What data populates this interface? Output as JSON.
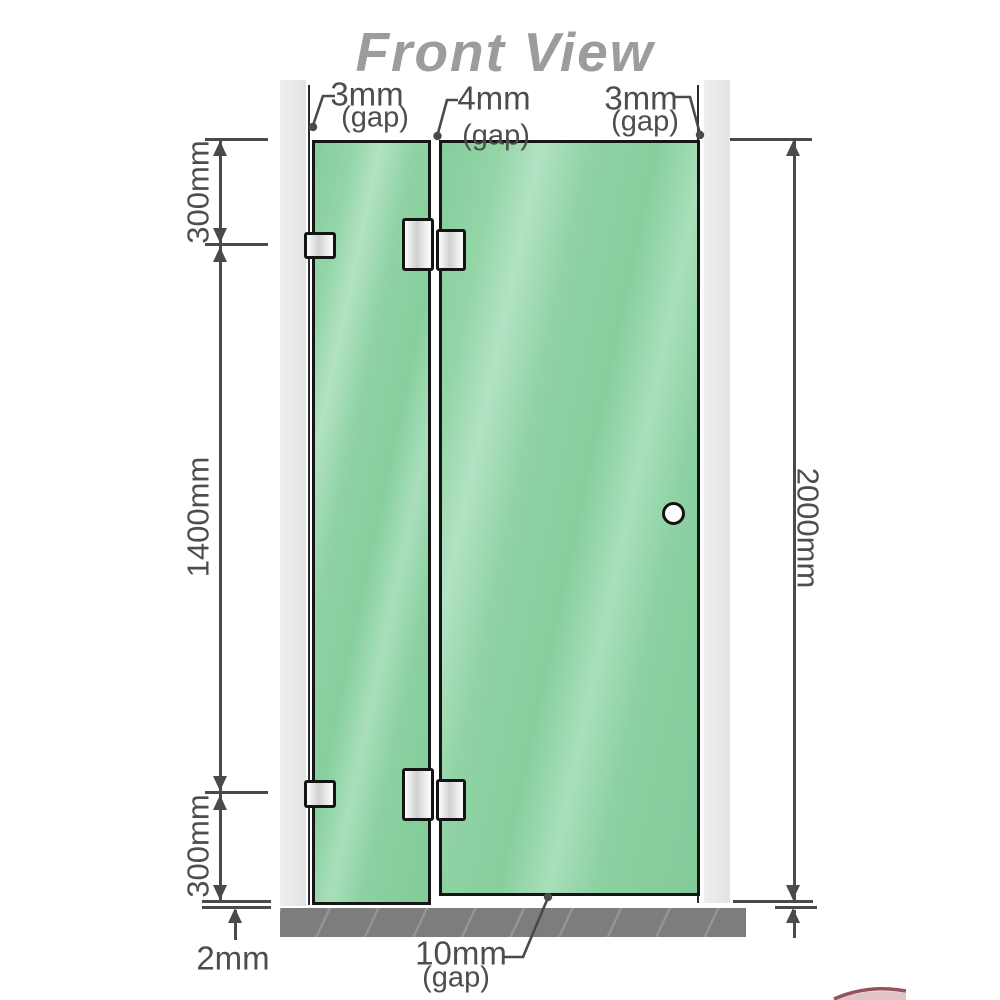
{
  "title": "Front View",
  "gaps": {
    "left": {
      "value": "3mm",
      "note": "(gap)"
    },
    "middle": {
      "value": "4mm",
      "note": "(gap)"
    },
    "right": {
      "value": "3mm",
      "note": "(gap)"
    },
    "bottom_door": {
      "value": "10mm",
      "note": "(gap)"
    },
    "bottom_floor": {
      "value": "2mm"
    }
  },
  "heights": {
    "top_segment": "300mm",
    "middle_segment": "1400mm",
    "bottom_segment": "300mm",
    "total": "2000mm"
  },
  "colors": {
    "glass": "#8ed2a5",
    "glass_highlight": "#b2e2c3",
    "wall": "#e9e9e9",
    "floor": "#7d7d7d",
    "dimension_line": "#4a4a4a",
    "title_text": "#9c9c9c",
    "hardware": "#f2f2f2",
    "watermark_red": "#7c2733"
  }
}
